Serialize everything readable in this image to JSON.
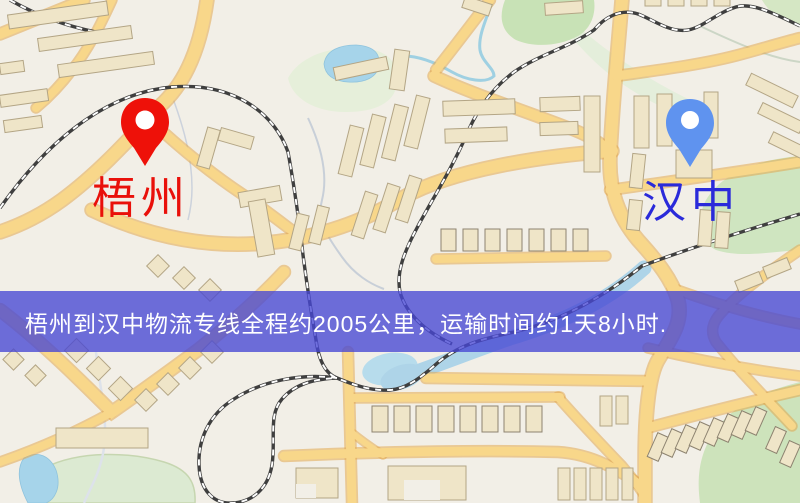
{
  "markers": {
    "origin": {
      "label": "梧州",
      "pin_color": "#ee1109",
      "label_color": "#e9100a"
    },
    "destination": {
      "label": "汉中",
      "pin_color": "#5f93ef",
      "label_color": "#2a2ada"
    }
  },
  "banner": {
    "text": "梧州到汉中物流专线全程约2005公里，运输时间约1天8小时.",
    "background": "rgba(70,70,212,0.78)",
    "text_color": "#ffffff",
    "distance_km": "2005",
    "duration": "1天8小时"
  }
}
